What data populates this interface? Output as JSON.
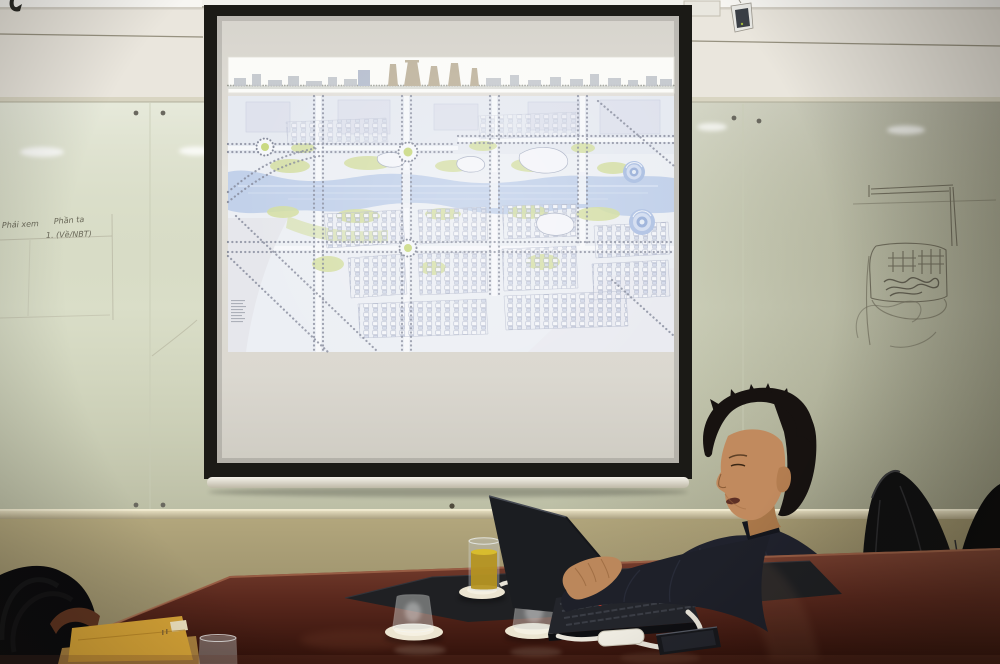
{
  "whiteboard_notes": {
    "line1": "Phải xem",
    "line2": "Phần ta",
    "line3": "1. (Về/NBT)"
  },
  "colors": {
    "wall_upper": "#eae6dd",
    "glass": "#dde1cc",
    "wall_lower": "#b2a67c",
    "screen_frame": "#1b1a16",
    "map_bg": "#e9ecf2",
    "map_river": "#b7c9e6",
    "map_green": "#ccd98f",
    "skyline_tower": "#b3a68c",
    "table_panel": "#1f2023",
    "shirt": "#20222d",
    "hair": "#171210",
    "skin": "#c18a5e",
    "chair": "#101011",
    "laptop_body": "#1b1d21",
    "tea": "#b5921d",
    "saucer": "#ece5d1",
    "envelope": "#d7a437",
    "cable": "#e9e5da",
    "phone": "#17181c"
  }
}
